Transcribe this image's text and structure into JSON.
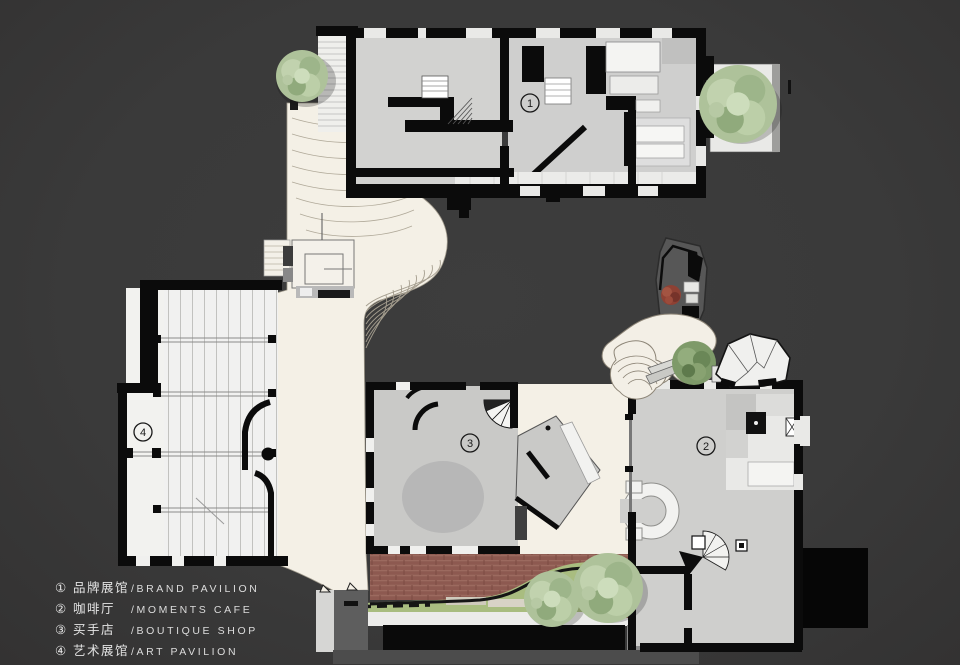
{
  "page": {
    "background": "#3a3a3a"
  },
  "legend": {
    "items": [
      {
        "symbol": "①",
        "zh": "品牌展馆",
        "en": "/BRAND PAVILION"
      },
      {
        "symbol": "②",
        "zh": "咖啡厅",
        "en": "/MOMENTS CAFE"
      },
      {
        "symbol": "③",
        "zh": "买手店",
        "en": "/BOUTIQUE SHOP"
      },
      {
        "symbol": "④",
        "zh": "艺术展馆",
        "en": "/ART PAVILION"
      }
    ]
  },
  "plan": {
    "markers": [
      {
        "id": "brand-pavilion",
        "number": "1"
      },
      {
        "id": "moments-cafe",
        "number": "2"
      },
      {
        "id": "boutique-shop",
        "number": "3"
      },
      {
        "id": "art-pavilion",
        "number": "4"
      }
    ],
    "colors": {
      "bg": "#3a3a3a",
      "cream": "#f4f0e6",
      "floor": "#d2d2d0",
      "floor-dark": "#c9c9c7",
      "wall": "#0b0b0b",
      "brick": "#8d5950",
      "lawn": "#a9bd80",
      "tower": "#575757",
      "white": "#f1f1ef",
      "accent-red": "#8e4134"
    }
  }
}
